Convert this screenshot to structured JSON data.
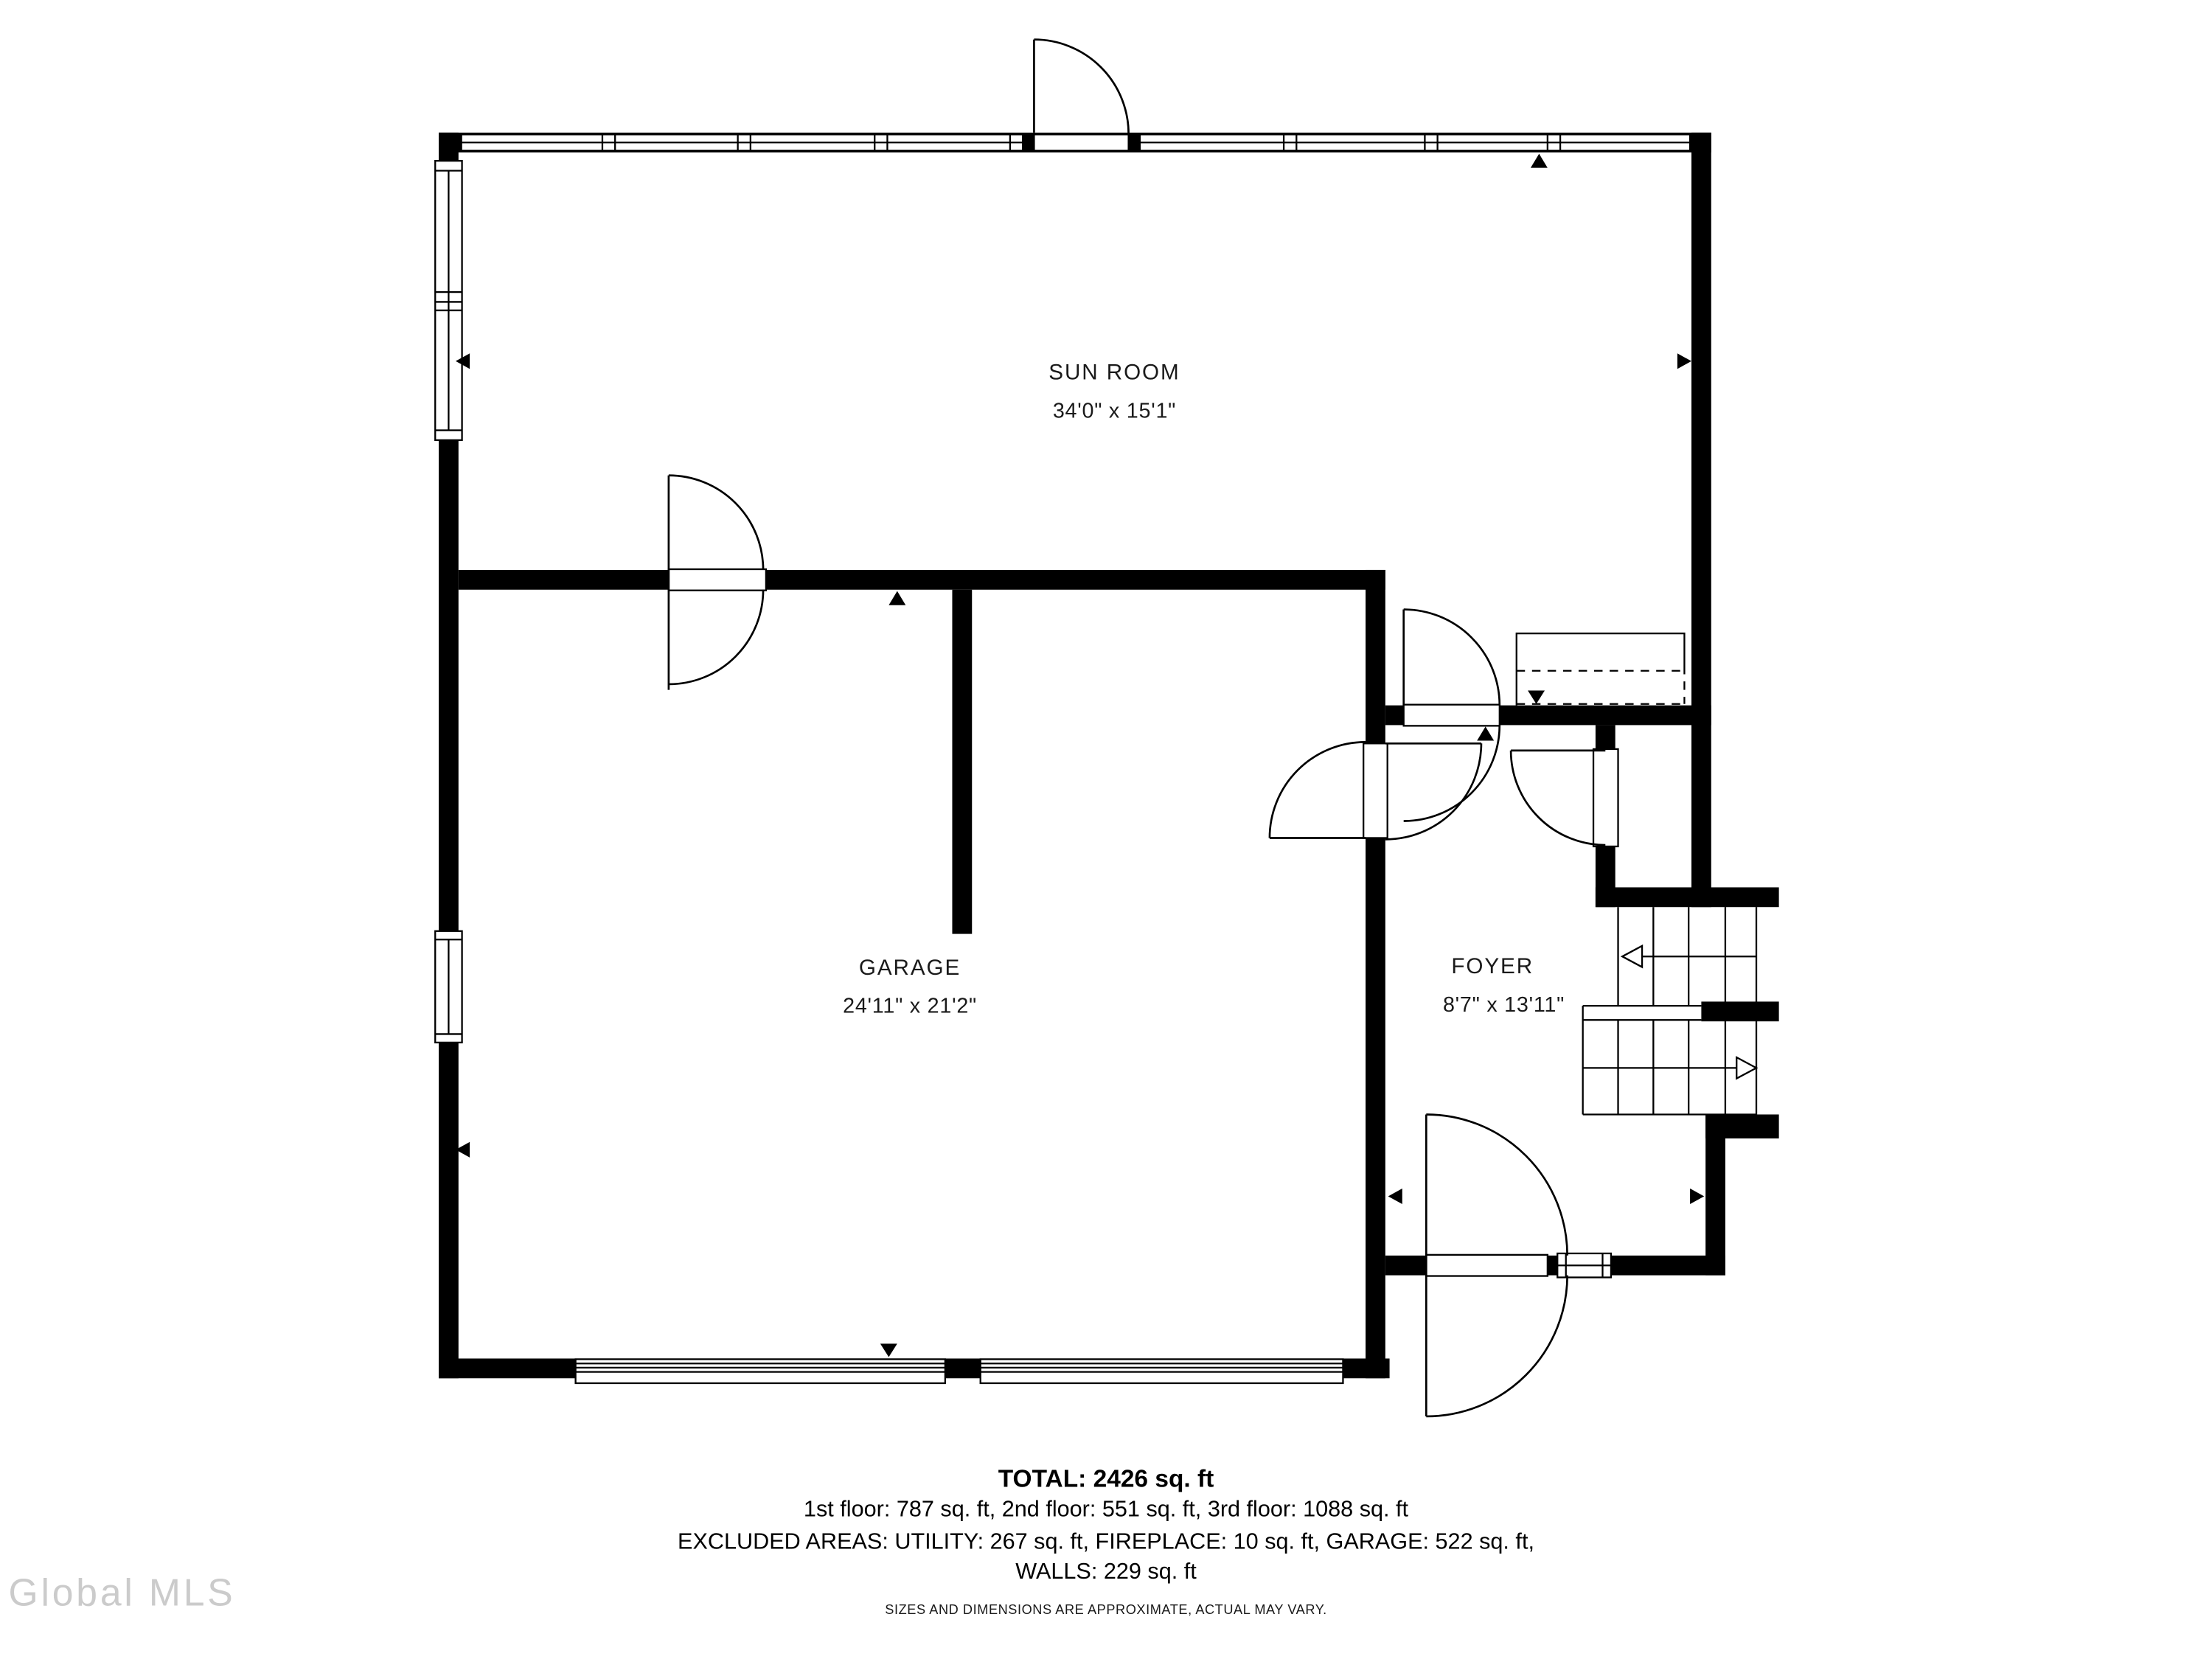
{
  "floor_plan": {
    "rooms": [
      {
        "name": "SUN ROOM",
        "dimensions": "34'0\" x 15'1\""
      },
      {
        "name": "GARAGE",
        "dimensions": "24'11\" x 21'2\""
      },
      {
        "name": "FOYER",
        "dimensions": "8'7\" x 13'11\""
      }
    ],
    "summary": {
      "total": "TOTAL: 2426 sq. ft",
      "floors": "1st floor: 787 sq. ft, 2nd floor: 551 sq. ft, 3rd floor: 1088 sq. ft",
      "excluded": "EXCLUDED AREAS: UTILITY: 267 sq. ft, FIREPLACE: 10 sq. ft, GARAGE: 522 sq. ft,",
      "walls": "WALLS: 229 sq. ft"
    },
    "disclaimer": "SIZES AND DIMENSIONS ARE APPROXIMATE, ACTUAL MAY VARY.",
    "watermark": "Global MLS",
    "colors": {
      "walls": "#000000",
      "background": "#ffffff",
      "watermark": "#c2c2c2"
    }
  }
}
